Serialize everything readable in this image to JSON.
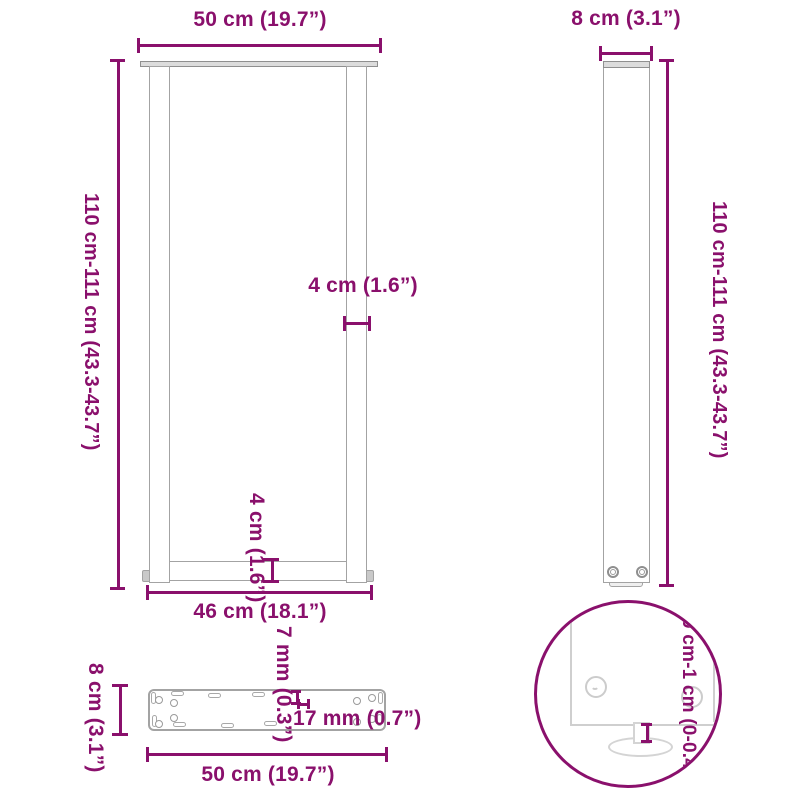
{
  "colors": {
    "accent": "#8a106c",
    "outline": "#a3a3a3",
    "outline_light": "#cccccc",
    "part_fill": "#dcdcdc"
  },
  "front_view": {
    "top_width": "50 cm (19.7”)",
    "height": "110 cm-111 cm (43.3-43.7”)",
    "leg_width": "4 cm (1.6”)",
    "bar_height": "4 cm (1.6”)",
    "bottom_width": "46 cm (18.1”)"
  },
  "side_view": {
    "depth": "8 cm (3.1”)",
    "height": "110 cm-111 cm (43.3-43.7”)"
  },
  "plate_view": {
    "depth": "8 cm (3.1”)",
    "slot_small": "7 mm (0.3”)",
    "slot_large": "17 mm (0.7”)",
    "width": "50 cm (19.7”)"
  },
  "detail_view": {
    "adjustment": "0 cm-1 cm (0-0.4”)"
  }
}
